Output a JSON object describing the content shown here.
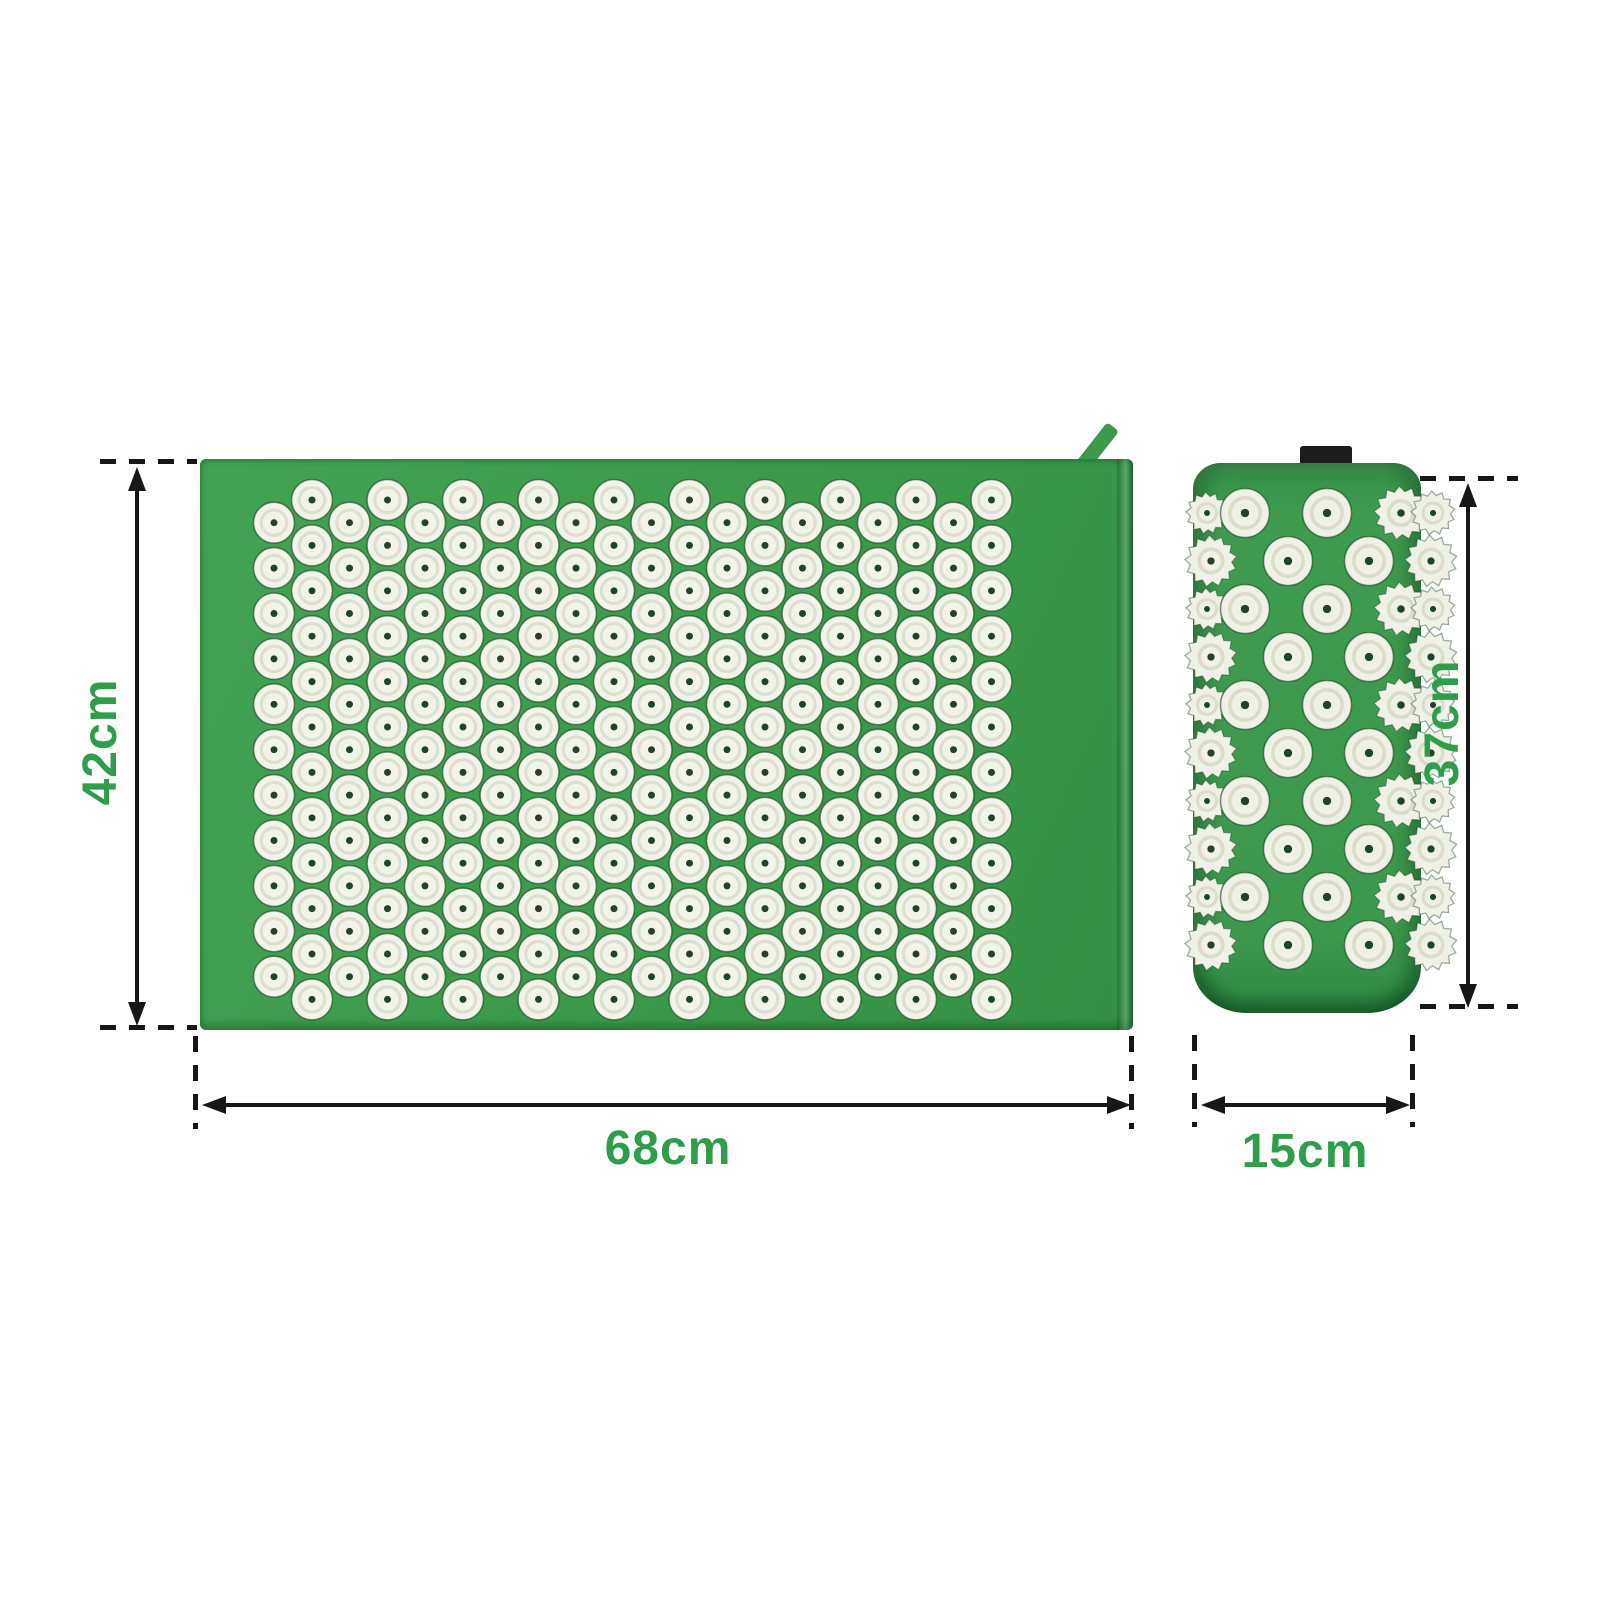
{
  "product_diagram": {
    "mat": {
      "height_label": "42cm",
      "width_label": "68cm",
      "color": "#3b9a4a",
      "spike": {
        "fill": "#f2f3e9",
        "ring": "#dde0cf",
        "dot": "#1e4527",
        "rows": 23,
        "per_row": 10
      }
    },
    "pillow": {
      "height_label": "37cm",
      "width_label": "15cm",
      "color": "#3f9c4e",
      "tab_color": "#1d1d1d",
      "spike": {
        "fill": "#f0f1e6",
        "ring": "#dadcc9",
        "dot": "#1e4527",
        "rows": 10
      }
    },
    "annotation": {
      "line_color": "#171717",
      "label_color": "#2f9e4b"
    }
  }
}
